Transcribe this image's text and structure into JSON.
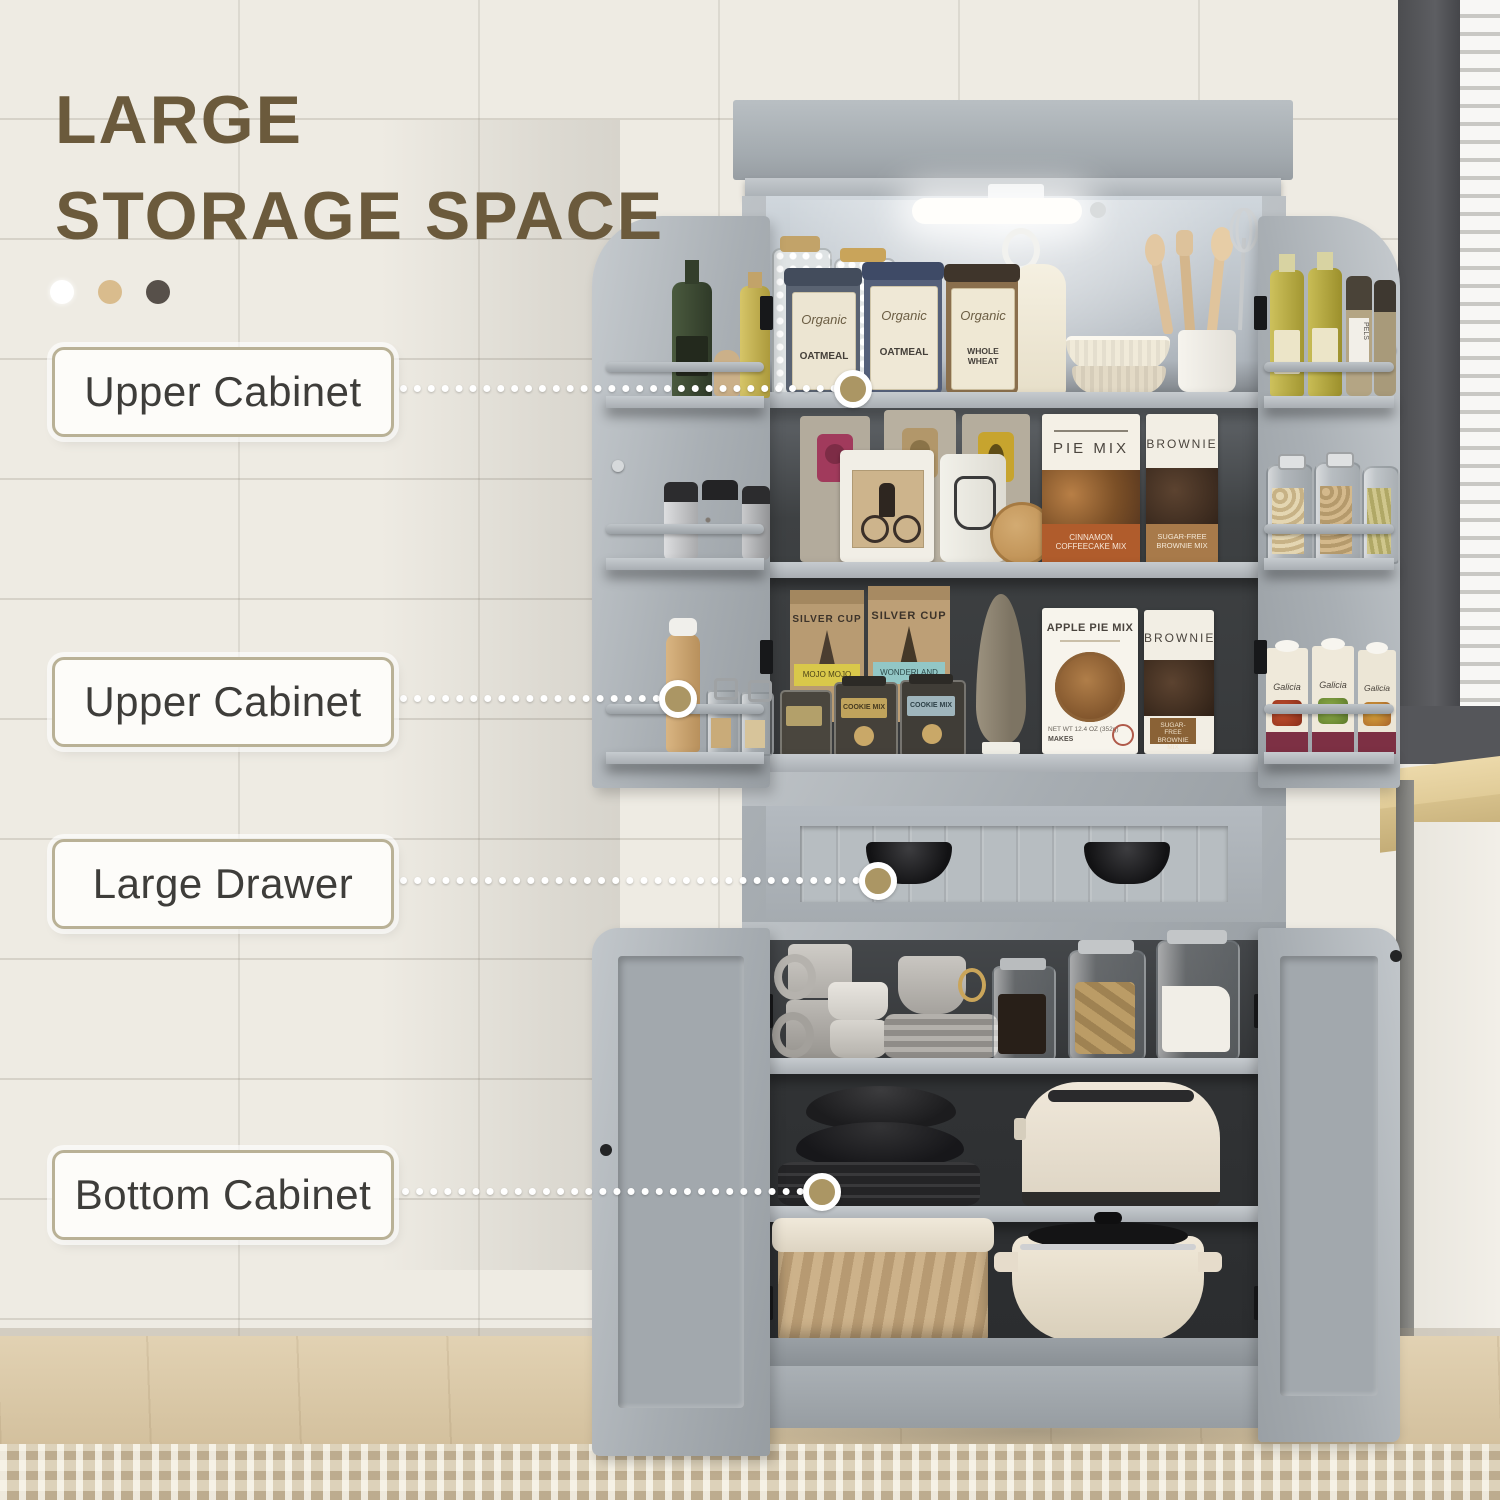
{
  "header": {
    "title_line1": "LARGE",
    "title_line2": "STORAGE SPACE",
    "accent_dots": [
      "#ffffff",
      "#d9bc8d",
      "#57504a"
    ]
  },
  "callouts": [
    {
      "label": "Upper Cabinet"
    },
    {
      "label": "Upper Cabinet"
    },
    {
      "label": "Large Drawer"
    },
    {
      "label": "Bottom Cabinet"
    }
  ],
  "products": {
    "canister_brand": "Organic",
    "canisters": [
      "OATMEAL",
      "OATMEAL",
      "WHOLE WHEAT"
    ],
    "pie_mix": {
      "title": "PIE MIX",
      "band": "CINNAMON COFFEECAKE MIX"
    },
    "brownie_upper": {
      "title": "BROWNIE",
      "band": "SUGAR-FREE BROWNIE MIX"
    },
    "bag_brand": "SILVER CUP",
    "bag_bands": [
      "MOJO MOJO",
      "WONDERLAND"
    ],
    "cookie_jar_label": "COOKIE MIX",
    "apple_pie": {
      "title": "APPLE PIE MIX",
      "weight": "NET WT 12.4 OZ (352g)",
      "makes": "MAKES"
    },
    "brownie_lower": {
      "title": "BROWNIE",
      "band": "SUGAR-FREE BROWNIE MIX"
    },
    "carton_brand": "Galicia",
    "grinder_label": "PELS"
  },
  "palette": {
    "title_text": "#6b5a3c",
    "cabinet_gray": "#a9afb4",
    "interior_dark": "#3c3f41",
    "leader_end": "#ab9664",
    "label_border": "#b9b196"
  }
}
